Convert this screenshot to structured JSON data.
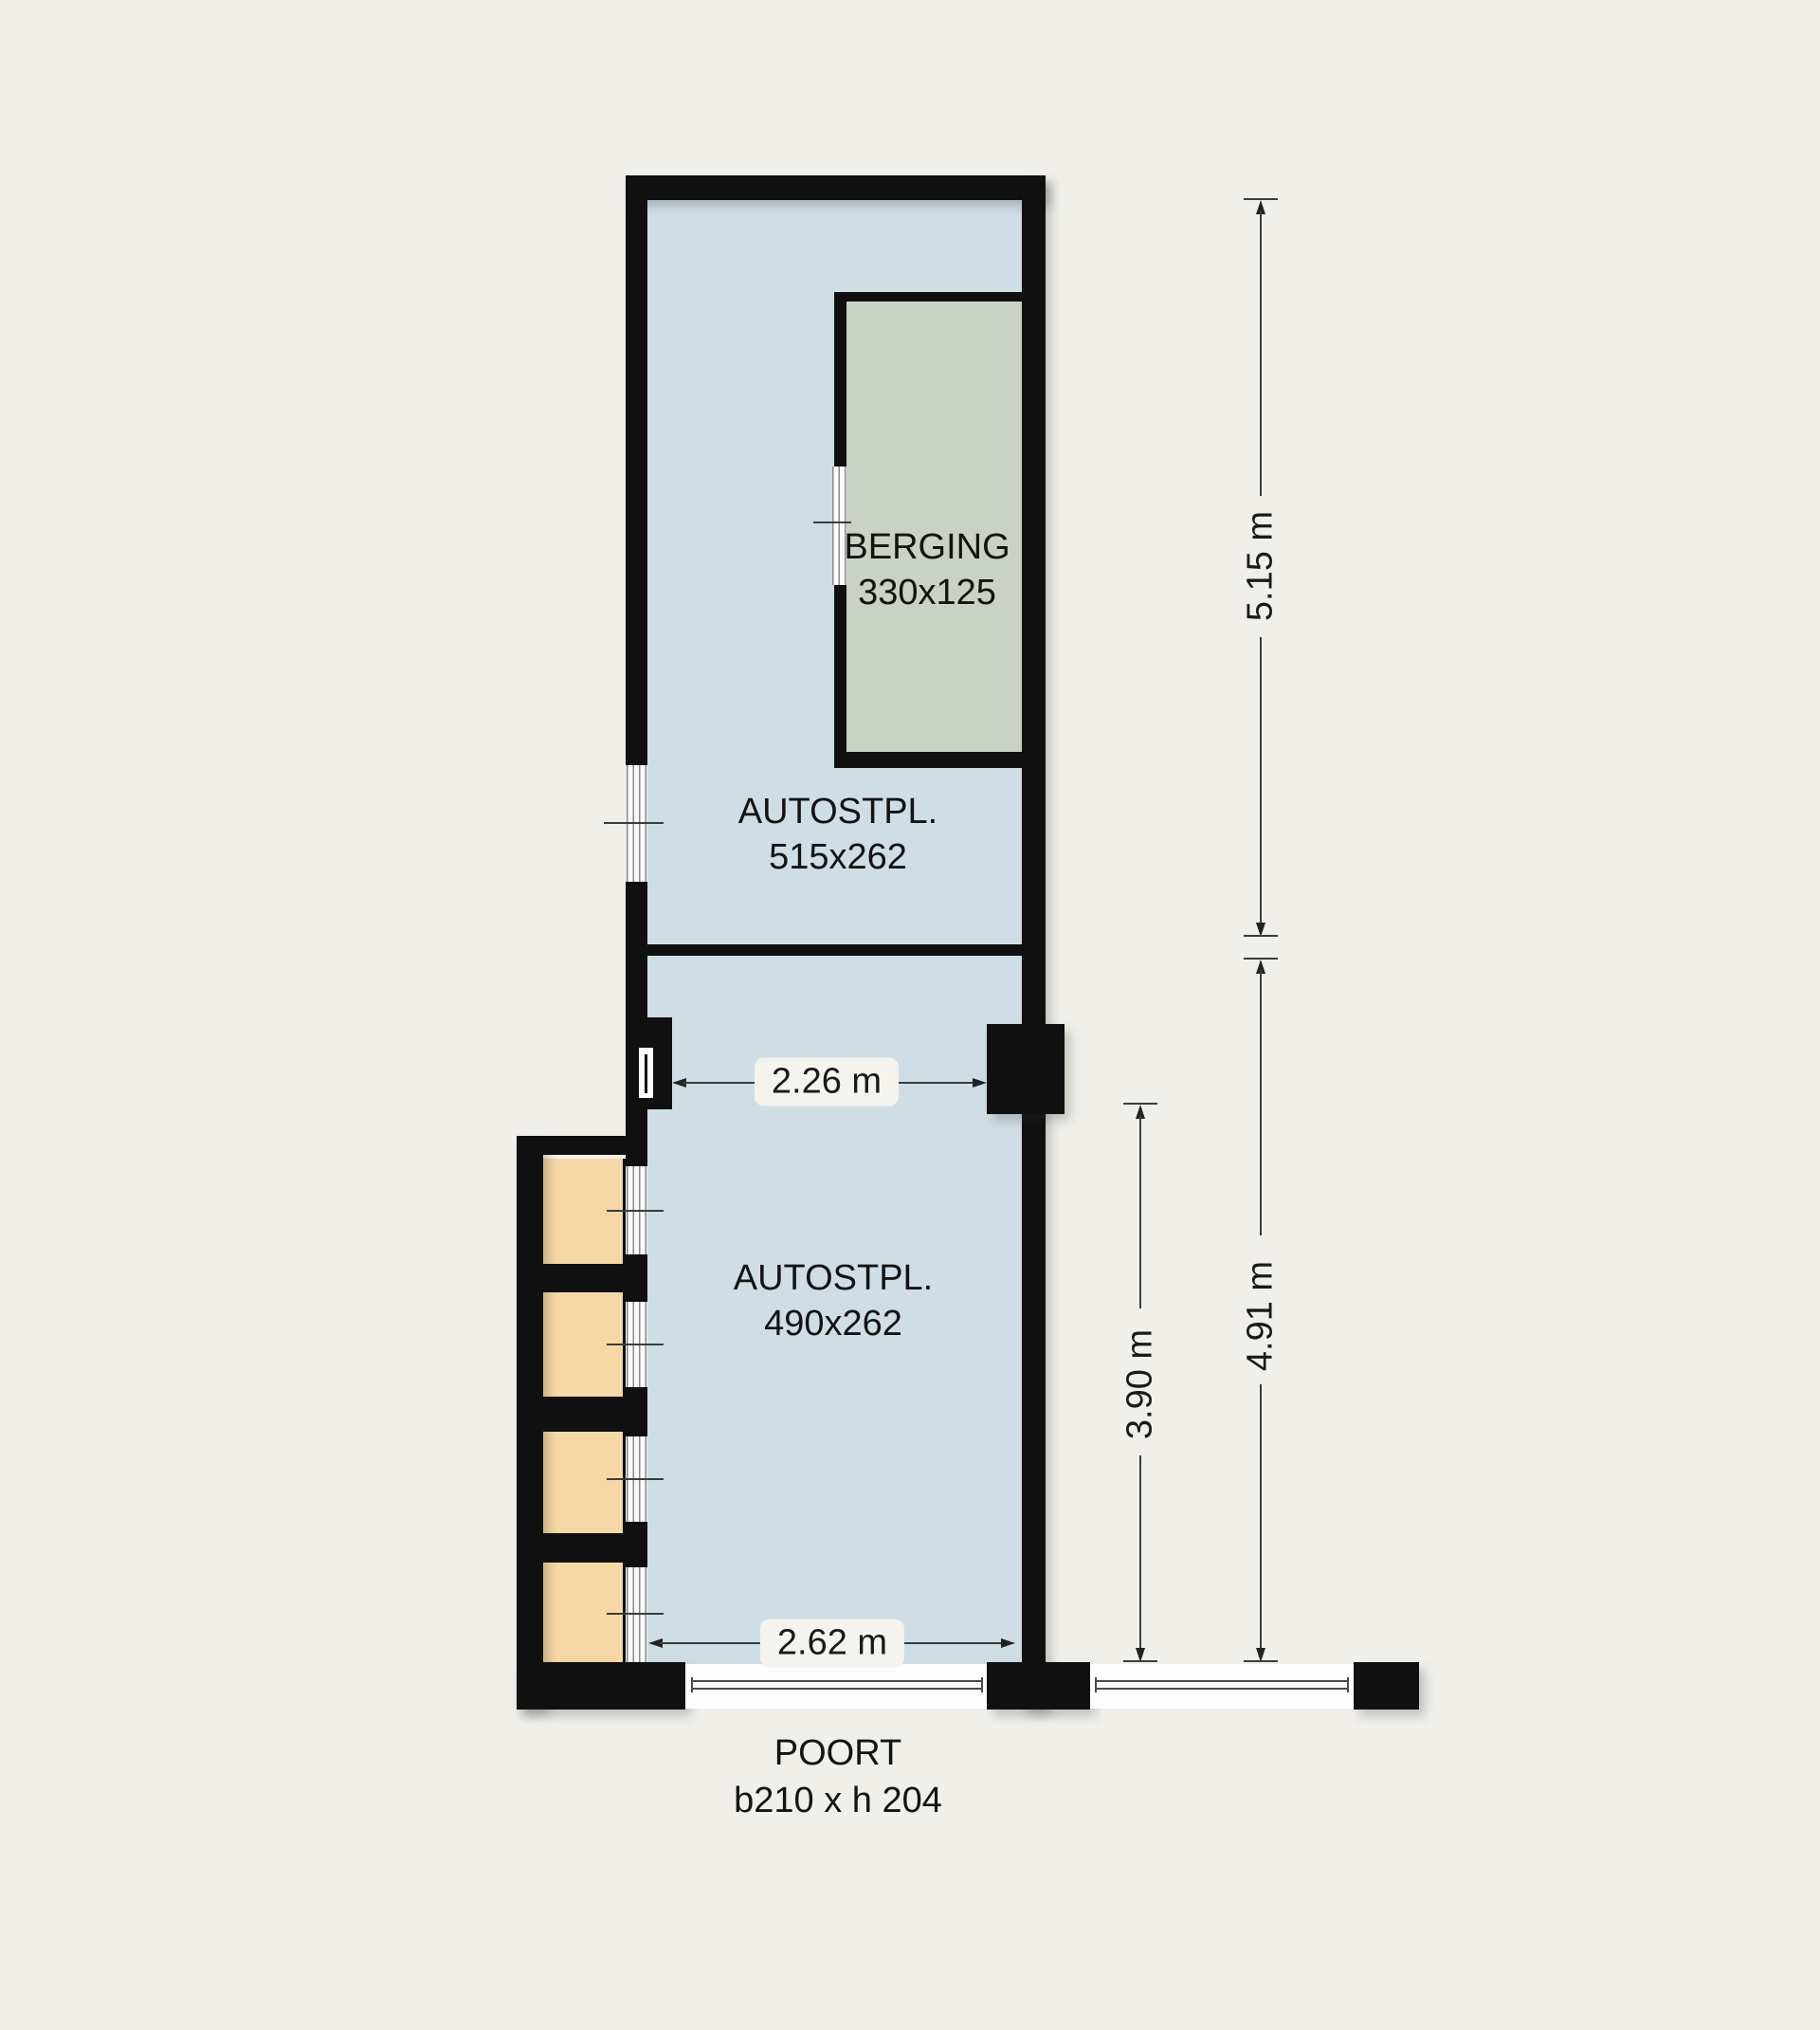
{
  "title": "Garage floor plan",
  "colors": {
    "background": "#f0efea",
    "wall": "#101010",
    "parking_fill": "#cfdee5",
    "berging_fill": "#c9d2c4",
    "box_fill": "#f5d8a6",
    "label_pill": "#f4f3ee",
    "dim_line": "#3c3c3c"
  },
  "rooms": {
    "berging": {
      "name": "BERGING",
      "size": "330x125"
    },
    "autostpl_upper": {
      "name": "AUTOSTPL.",
      "size": "515x262"
    },
    "autostpl_lower": {
      "name": "AUTOSTPL.",
      "size": "490x262"
    }
  },
  "gate": {
    "name": "POORT",
    "size": "b210 x h 204"
  },
  "dimensions": {
    "height_upper": "5.15 m",
    "height_lower": "4.91 m",
    "height_inner": "3.90 m",
    "width_upper": "2.26 m",
    "width_lower": "2.62 m"
  },
  "storage_box_count": 4
}
